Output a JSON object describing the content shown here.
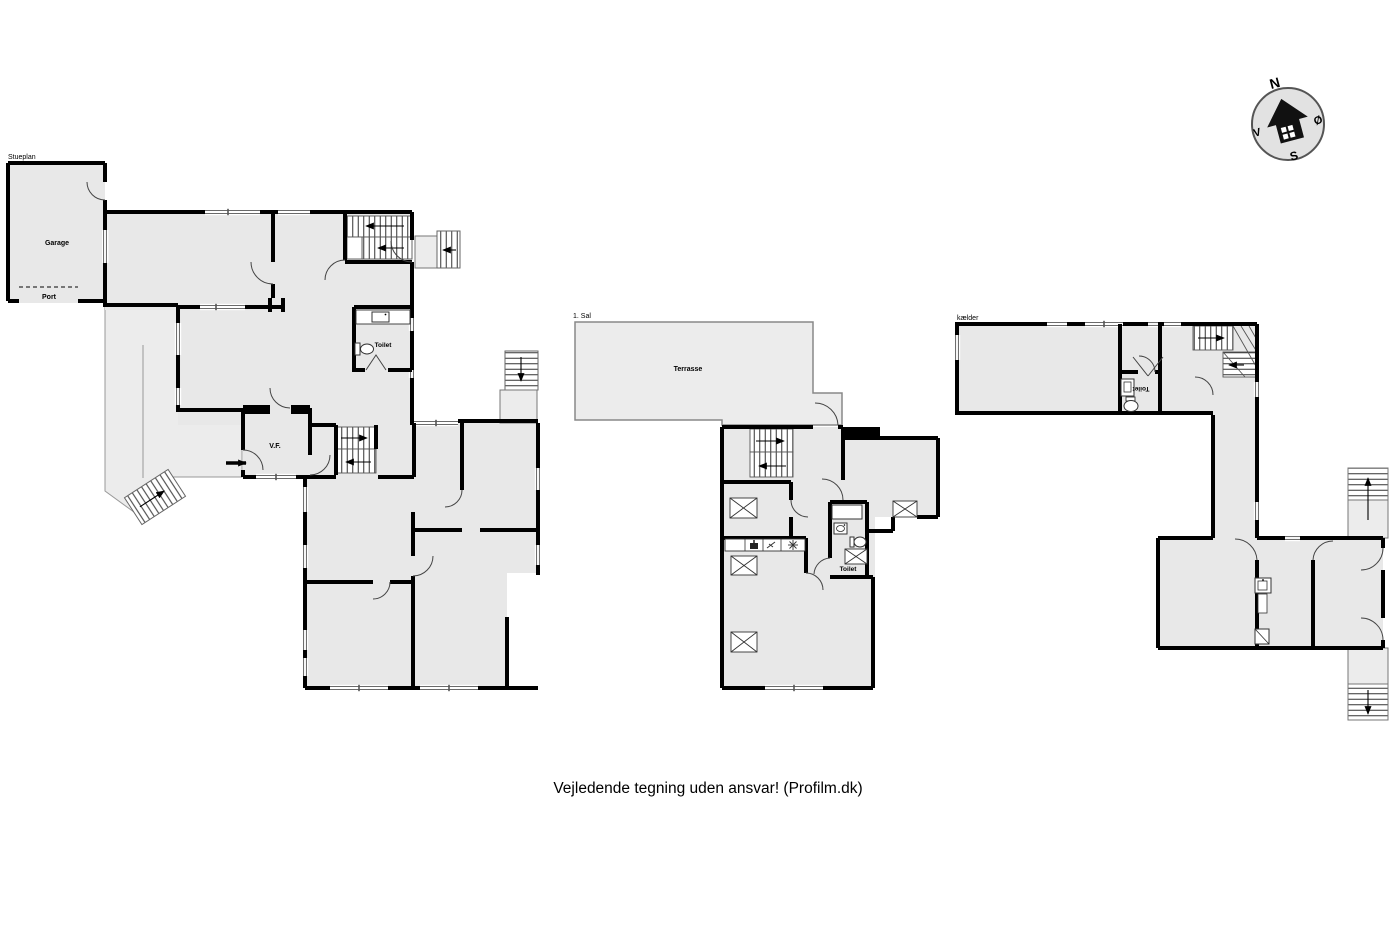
{
  "document": {
    "type": "floor-plan-drawing",
    "disclaimer": "Vejledende tegning uden ansvar! (Profilm.dk)"
  },
  "plans": {
    "stueplan": {
      "title": "Stueplan",
      "labels": {
        "garage": "Garage",
        "port": "Port",
        "toilet": "Toilet",
        "vf": "V.F."
      }
    },
    "sal1": {
      "title": "1. Sal",
      "labels": {
        "terrasse": "Terrasse",
        "toilet": "Toilet"
      }
    },
    "kaelder": {
      "title": "kælder",
      "labels": {
        "toilet": "Toilet"
      }
    }
  },
  "compass": {
    "north": "N",
    "east": "Ø",
    "south": "S",
    "west": "V"
  },
  "colors": {
    "background": "#ffffff",
    "floor": "#e8e8e8",
    "outdoor": "#ececec",
    "wall": "#000000",
    "thin_line": "#777777",
    "compass_fill": "#e2e2e2"
  },
  "icons": [
    "compass-house-icon",
    "toilet-icon",
    "sink-icon",
    "bath-icon",
    "skylight-icon",
    "kitchen-counter-icon",
    "hob-icon",
    "faucet-icon",
    "freezer-icon",
    "stair-arrow-icon",
    "entry-arrow-icon"
  ]
}
